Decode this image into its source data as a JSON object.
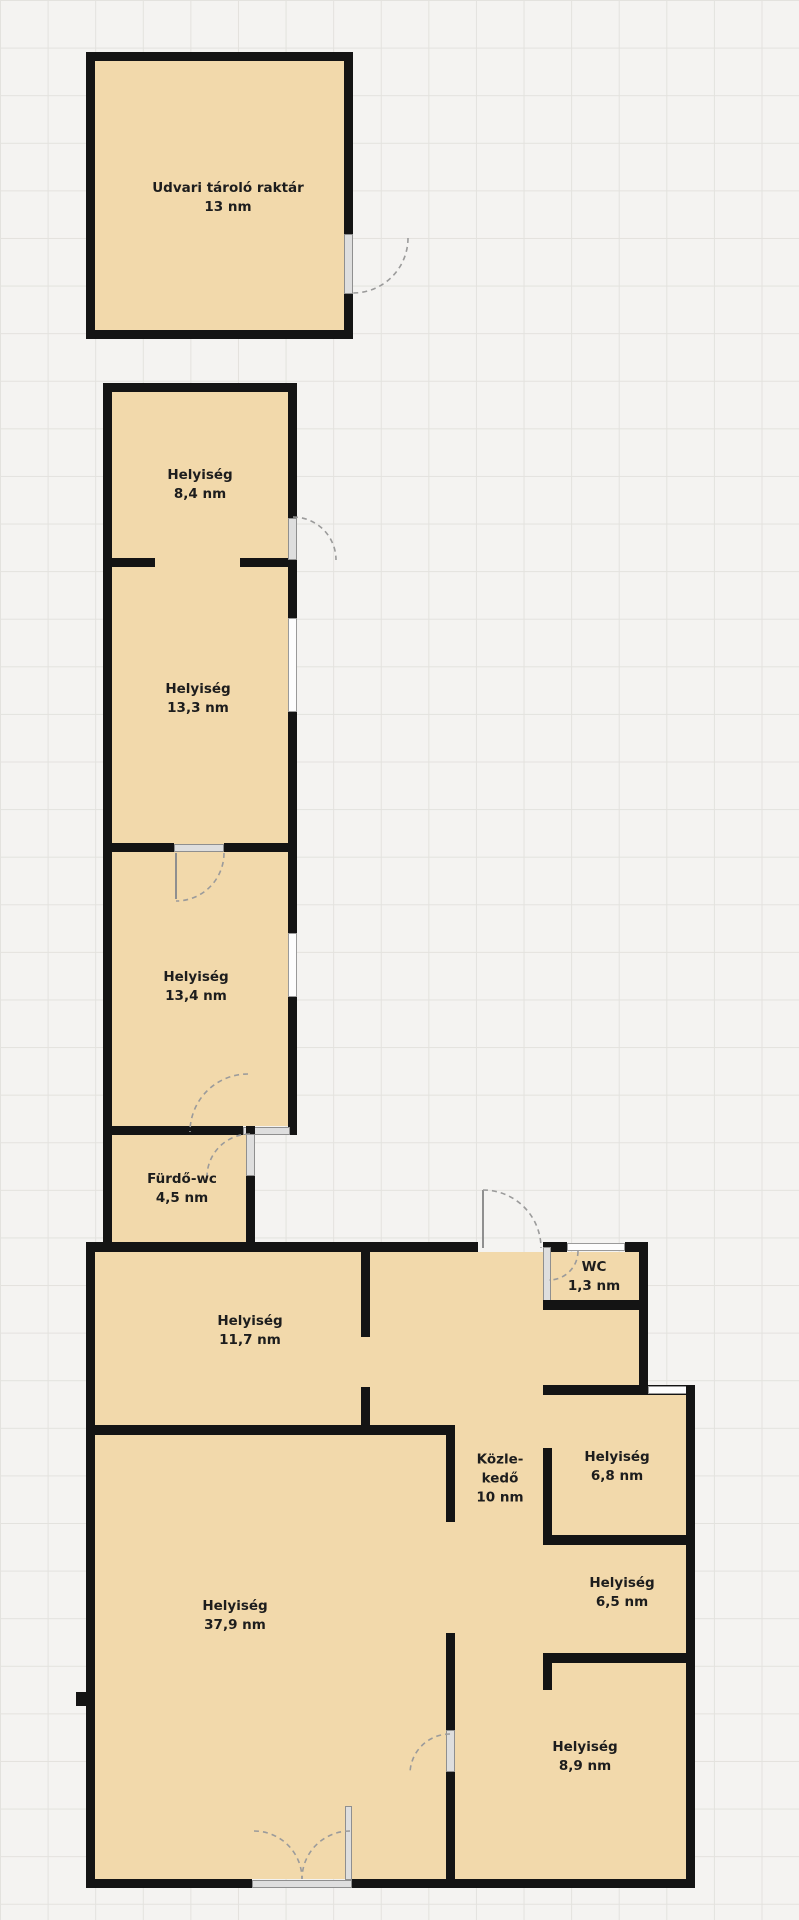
{
  "plan": {
    "type": "floor-plan",
    "units_suffix": "nm",
    "colors": {
      "background": "#f4f3f1",
      "grid_line": "#e3e2de",
      "room_fill": "#f2d9ab",
      "wall": "#141414",
      "door_fill": "#dedede",
      "door_border": "#8f8f8f",
      "window_fill": "#fdfdfd",
      "window_border": "#9a9a9a",
      "arc": "#9b9b9b",
      "text": "#1d1d1d"
    },
    "rooms": [
      {
        "name": "Udvari tároló raktár",
        "area": "13 nm"
      },
      {
        "name": "Helyiség",
        "area": "8,4 nm"
      },
      {
        "name": "Helyiség",
        "area": "13,3 nm"
      },
      {
        "name": "Helyiség",
        "area": "13,4 nm"
      },
      {
        "name": "Fürdő-wc",
        "area": "4,5 nm"
      },
      {
        "name": "Helyiség",
        "area": "11,7 nm"
      },
      {
        "name": "WC",
        "area": "1,3 nm"
      },
      {
        "name": "Közle-",
        "name2": "kedő",
        "area": "10 nm"
      },
      {
        "name": "Helyiség",
        "area": "6,8 nm"
      },
      {
        "name": "Helyiség",
        "area": "6,5 nm"
      },
      {
        "name": "Helyiség",
        "area": "37,9 nm"
      },
      {
        "name": "Helyiség",
        "area": "8,9 nm"
      }
    ]
  }
}
